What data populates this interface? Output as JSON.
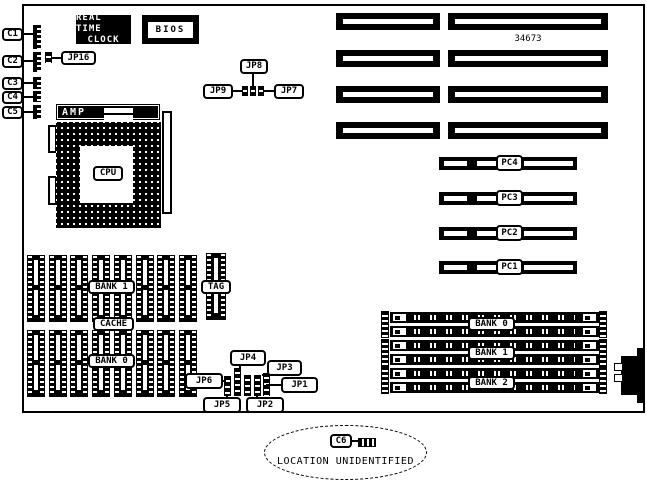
{
  "colors": {
    "ink": "#000000",
    "paper": "#ffffff"
  },
  "board": {
    "part_number": "34673",
    "edge_connectors": [
      {
        "label": "C1"
      },
      {
        "label": "C2"
      },
      {
        "label": "C3"
      },
      {
        "label": "C4"
      },
      {
        "label": "C5"
      }
    ],
    "rtc": {
      "line1": "REAL TIME",
      "line2": "CLOCK"
    },
    "bios": "BIOS",
    "amp": "AMP",
    "cpu": "CPU",
    "jp16": "JP16",
    "top_jumpers": {
      "jp8": "JP8",
      "jp9": "JP9",
      "jp7": "JP7"
    },
    "pc_slots": [
      {
        "label": "PC4"
      },
      {
        "label": "PC3"
      },
      {
        "label": "PC2"
      },
      {
        "label": "PC1"
      }
    ],
    "cache": {
      "bank1": "BANK 1",
      "cache": "CACHE",
      "bank0": "BANK 0",
      "tag": "TAG"
    },
    "bottom_jumpers": {
      "jp6": "JP6",
      "jp4": "JP4",
      "jp3": "JP3",
      "jp1": "JP1",
      "jp5": "JP5",
      "jp2": "JP2"
    },
    "simm_banks": [
      {
        "label": "BANK 0"
      },
      {
        "label": "BANK 1"
      },
      {
        "label": "BANK 2"
      }
    ]
  },
  "callout": {
    "label": "C6",
    "text": "LOCATION UNIDENTIFIED"
  }
}
